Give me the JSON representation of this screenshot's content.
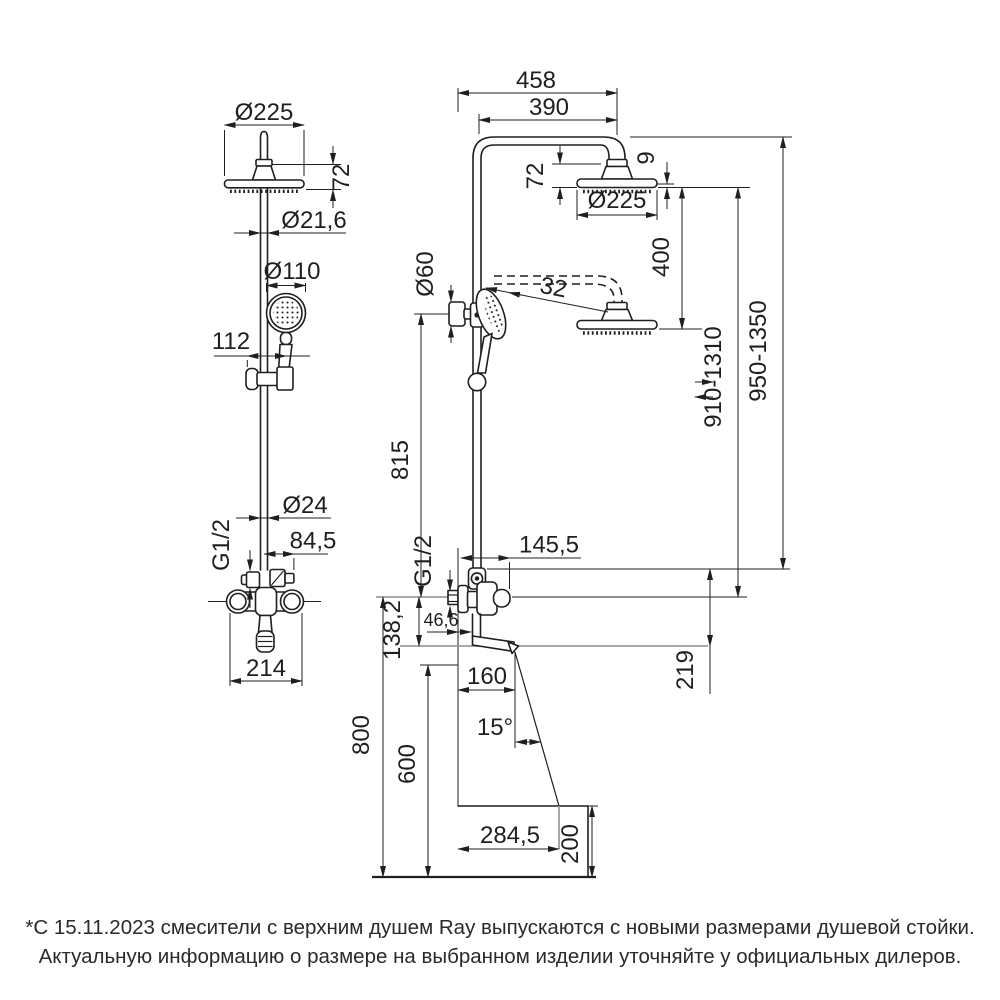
{
  "front_view": {
    "head_diameter": "Ø225",
    "head_height": "72",
    "pipe_diameter_top": "Ø21,6",
    "handshower_diameter": "Ø110",
    "bracket_offset": "112",
    "pipe_diameter": "Ø24",
    "thread_size": "G1/2",
    "outlet_offset": "84,5",
    "mixer_width": "214"
  },
  "side_view": {
    "reach_total": "458",
    "arm_reach": "390",
    "head_height": "72",
    "head_rim": "9",
    "head_diameter": "Ø225",
    "head_drop": "400",
    "bracket_diameter": "Ø60",
    "arm_note": "32",
    "column_height_max": "950-1350",
    "column_height_adjust": "910-1310",
    "bar_height": "815",
    "thread_size": "G1/2",
    "lever_depth": "145,5",
    "wall_offset": "46,6",
    "spout_drop": "138,2",
    "outlet_height": "219",
    "spout_reach": "160",
    "stream_angle": "15°",
    "clearance_height": "600",
    "install_height": "800",
    "stream_reach": "284,5",
    "zone_depth": "200"
  },
  "footnote": {
    "line1": "*С 15.11.2023 смесители с верхним душем Ray выпускаются с новыми размерами душевой стойки.",
    "line2": "Актуальную информацию о размере на выбранном изделии уточняйте у официальных дилеров."
  },
  "colors": {
    "line": "#1f1f1f",
    "reference": "#9b9b9b",
    "background": "#ffffff"
  }
}
